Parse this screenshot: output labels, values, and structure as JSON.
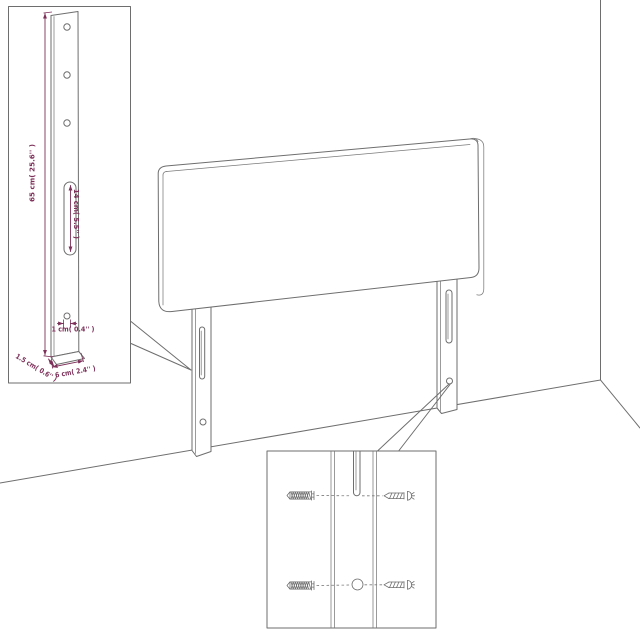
{
  "colors": {
    "background": "#ffffff",
    "outline_gray": "#6e6e6e",
    "dimension_maroon": "#7d3059"
  },
  "leg_detail": {
    "height_label": "65 cm( 25.6'' )",
    "slot_label": "14 cm( 5.5'' )",
    "hole_label": "1 cm( 0.4'' )",
    "depth_label": "1.5 cm( 0.6'' )",
    "width_label": "6 cm( 2.4'' )"
  },
  "icons": {
    "wall_plug": "wall-plug-icon",
    "screw": "screw-icon",
    "screw_hole": "screw-hole-icon",
    "mounting_slot": "mounting-slot-icon"
  }
}
